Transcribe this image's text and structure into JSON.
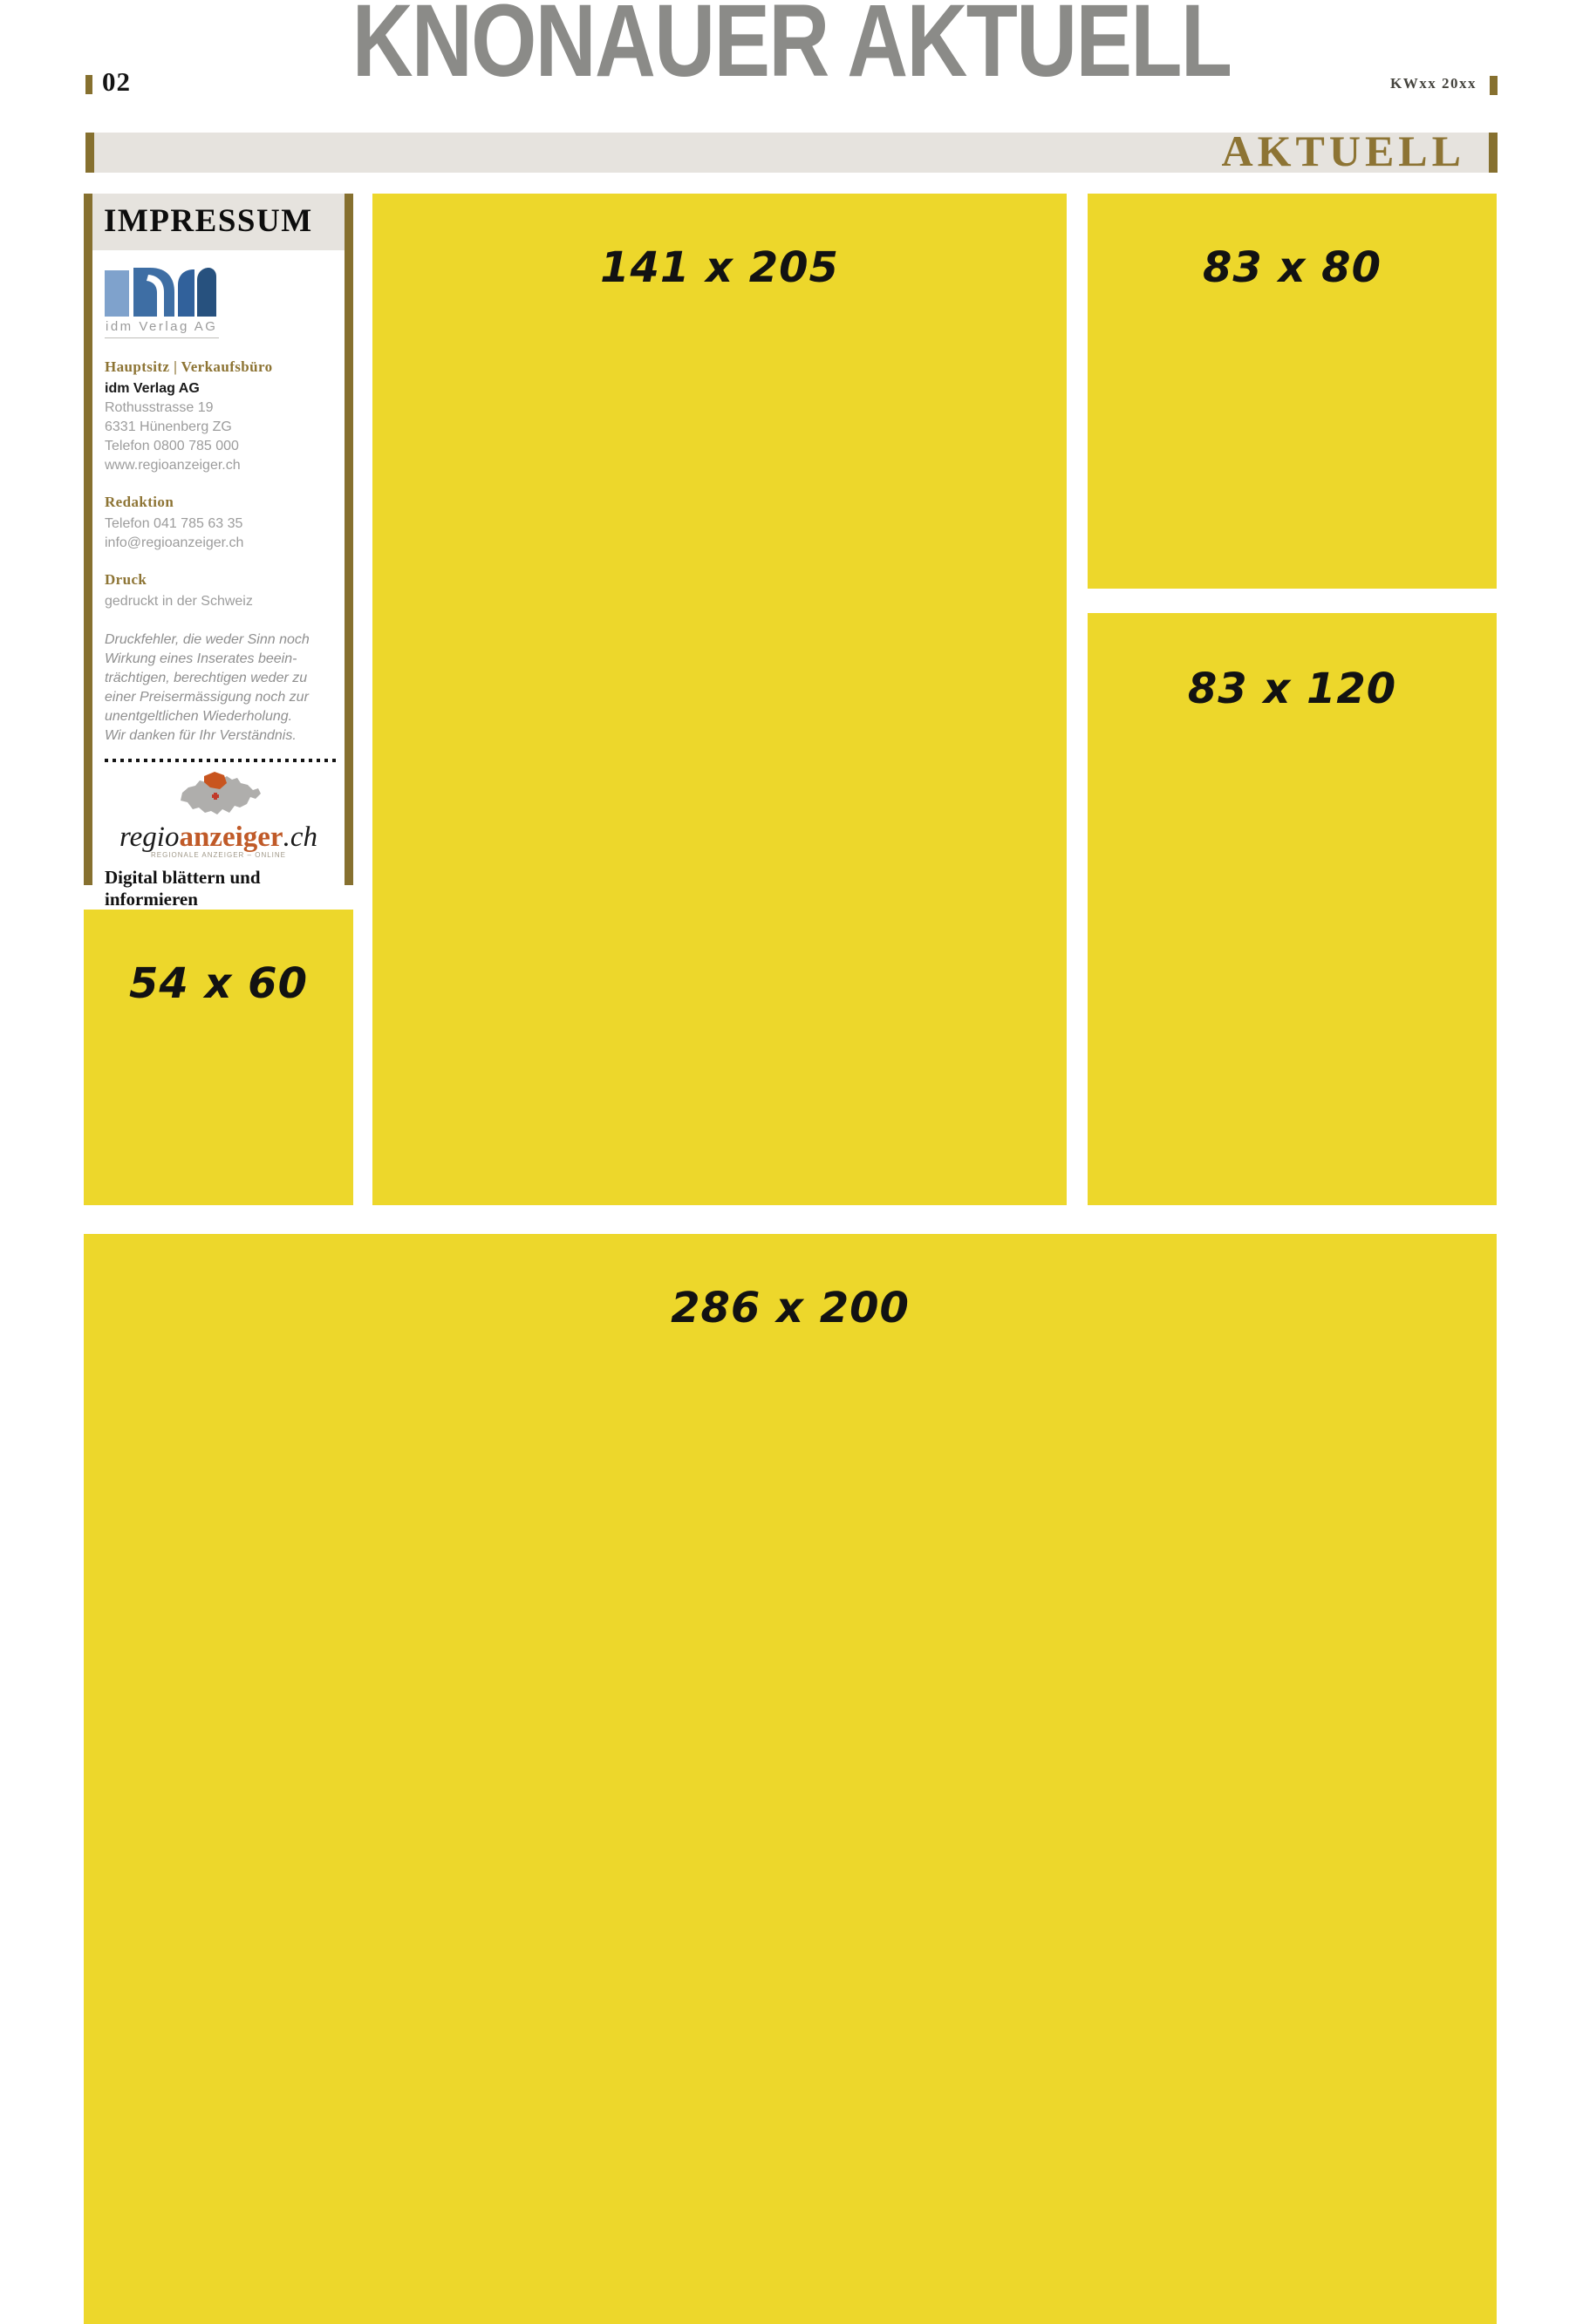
{
  "page": {
    "number": "02",
    "masthead": "KNONAUER AKTUELL",
    "issue": "KWxx 20xx",
    "section_label": "AKTUELL"
  },
  "impressum": {
    "title": "IMPRESSUM",
    "logo_caption": "idm Verlag AG",
    "sections": [
      {
        "heading": "Hauptsitz | Verkaufsbüro",
        "company": "idm Verlag AG",
        "lines": [
          "Rothusstrasse 19",
          "6331 Hünenberg ZG",
          "Telefon 0800 785 000",
          "www.regioanzeiger.ch"
        ]
      },
      {
        "heading": "Redaktion",
        "lines": [
          "Telefon 041 785 63 35",
          "info@regioanzeiger.ch"
        ]
      },
      {
        "heading": "Druck",
        "lines": [
          "gedruckt in der Schweiz"
        ]
      }
    ],
    "disclaimer_lines": [
      "Druckfehler, die weder Sinn noch",
      "Wirkung eines Inserates beein-",
      "trächtigen, berechtigen weder zu",
      "einer Preisermässigung noch zur",
      "unentgeltlichen Wiederholung.",
      "Wir danken für Ihr Verständnis."
    ],
    "brand": {
      "regio": "regio",
      "anzeiger": "anzeiger",
      "tld": ".ch",
      "tagline": "REGIONALE ANZEIGER – ONLINE"
    },
    "footer_line1": "Digital blättern und",
    "footer_line2": "informieren"
  },
  "ad_slots": [
    {
      "id": "slot-141x205",
      "label": "141 x 205"
    },
    {
      "id": "slot-83x80",
      "label": "83 x 80"
    },
    {
      "id": "slot-83x120",
      "label": "83 x 120"
    },
    {
      "id": "slot-54x60",
      "label": "54 x 60"
    },
    {
      "id": "slot-286x200",
      "label": "286 x 200"
    }
  ],
  "colors": {
    "ad_yellow": "#EDD72B",
    "gold_bar": "#86702F",
    "gold_text": "#8D7434",
    "band_gray": "#E6E3DE",
    "masthead_gray": "#8B8B88",
    "body_gray": "#9C9C9C",
    "brand_orange": "#C05A28",
    "logo_blue_light": "#7FA2CC",
    "logo_blue_mid": "#3E6EA4",
    "logo_blue_dark": "#27517E"
  }
}
